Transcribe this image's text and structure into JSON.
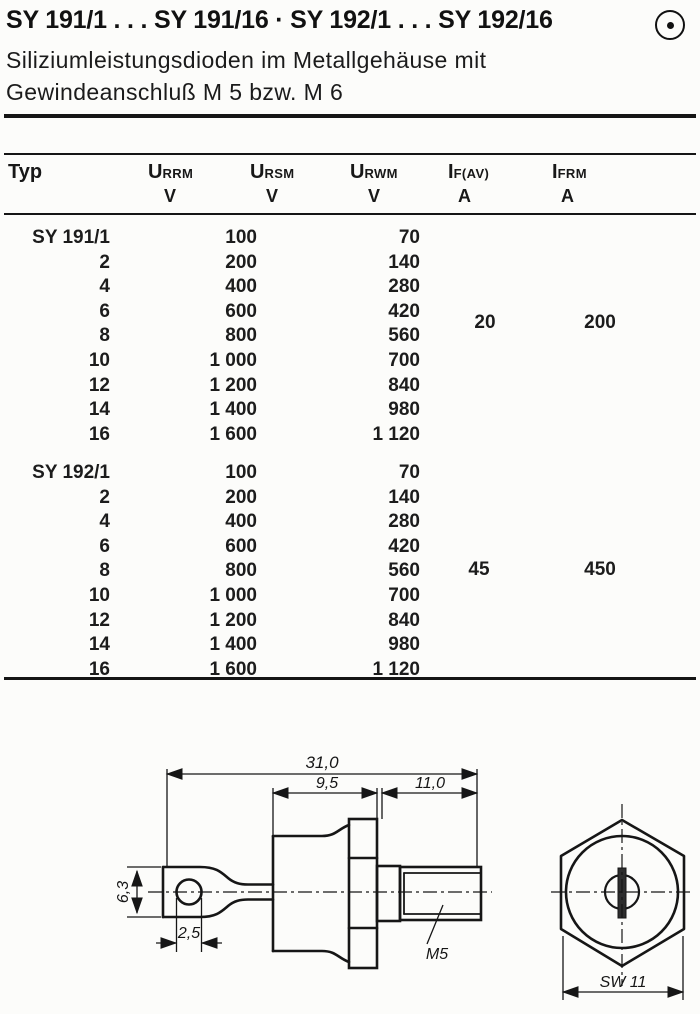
{
  "header": {
    "title": "SY 191/1 . . . SY 191/16 · SY 192/1 . . . SY 192/16",
    "subtitle_line1": "Siliziumleistungsdioden im Metallgehäuse mit",
    "subtitle_line2": "Gewindeanschluß M 5 bzw. M 6",
    "icon": "circled-dot"
  },
  "table": {
    "typ_label": "Typ",
    "columns": [
      {
        "symbol": "U",
        "sub": "RRM",
        "unit": "V"
      },
      {
        "symbol": "U",
        "sub": "RSM",
        "unit": "V"
      },
      {
        "symbol": "U",
        "sub": "RWM",
        "unit": "V"
      },
      {
        "symbol": "I",
        "sub": "F(AV)",
        "unit": "A"
      },
      {
        "symbol": "I",
        "sub": "FRM",
        "unit": "A"
      }
    ],
    "groups": [
      {
        "name": "SY 191",
        "if_av": "20",
        "ifrm": "200",
        "rows": [
          {
            "typ": "SY 191/1",
            "u1": "100",
            "u2": "70"
          },
          {
            "typ": "2",
            "u1": "200",
            "u2": "140"
          },
          {
            "typ": "4",
            "u1": "400",
            "u2": "280"
          },
          {
            "typ": "6",
            "u1": "600",
            "u2": "420"
          },
          {
            "typ": "8",
            "u1": "800",
            "u2": "560"
          },
          {
            "typ": "10",
            "u1": "1 000",
            "u2": "700"
          },
          {
            "typ": "12",
            "u1": "1 200",
            "u2": "840"
          },
          {
            "typ": "14",
            "u1": "1 400",
            "u2": "980"
          },
          {
            "typ": "16",
            "u1": "1 600",
            "u2": "1 120"
          }
        ]
      },
      {
        "name": "SY 192",
        "if_av": "45",
        "ifrm": "450",
        "rows": [
          {
            "typ": "SY 192/1",
            "u1": "100",
            "u2": "70"
          },
          {
            "typ": "2",
            "u1": "200",
            "u2": "140"
          },
          {
            "typ": "4",
            "u1": "400",
            "u2": "280"
          },
          {
            "typ": "6",
            "u1": "600",
            "u2": "420"
          },
          {
            "typ": "8",
            "u1": "800",
            "u2": "560"
          },
          {
            "typ": "10",
            "u1": "1 000",
            "u2": "700"
          },
          {
            "typ": "12",
            "u1": "1 200",
            "u2": "840"
          },
          {
            "typ": "14",
            "u1": "1 400",
            "u2": "980"
          },
          {
            "typ": "16",
            "u1": "1 600",
            "u2": "1 120"
          }
        ]
      }
    ]
  },
  "drawing": {
    "dims": {
      "overall_length": "31,0",
      "body_length": "9,5",
      "thread_length": "11,0",
      "lug_width": "6,3",
      "hole_diameter": "2,5",
      "thread_label": "M5",
      "wrench_size": "SW 11"
    }
  }
}
